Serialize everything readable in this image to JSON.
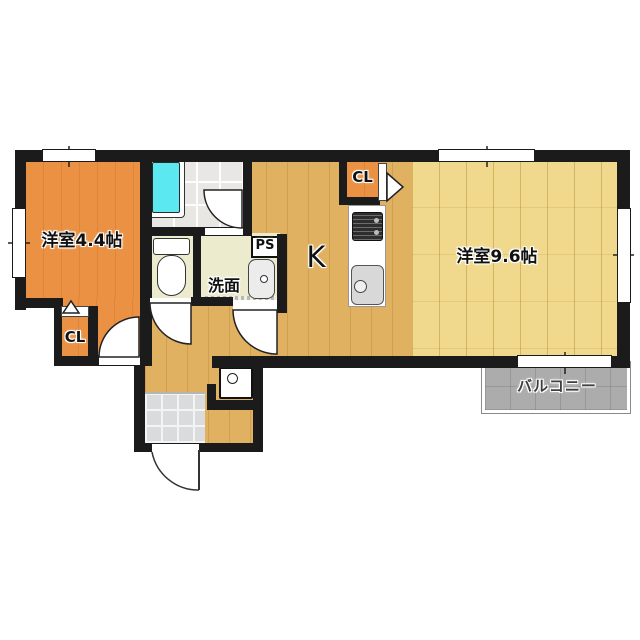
{
  "floorplan": {
    "type": "japanese-apartment-1K-floor-plan",
    "rooms": {
      "western_left": {
        "label": "洋室4.4帖"
      },
      "western_right": {
        "label": "洋室9.6帖"
      },
      "kitchen": {
        "label": "K"
      },
      "washroom": {
        "label": "洗面"
      },
      "balcony": {
        "label": "バルコニー"
      },
      "closet_left": {
        "label": "CL"
      },
      "closet_kitchen": {
        "label": "CL"
      },
      "pipe_shaft": {
        "label": "PS"
      }
    },
    "colors": {
      "wall": "#1b1b1b",
      "room_orange": "#ea9143",
      "wood_tan": "#dfb160",
      "wood_light": "#f0d98d",
      "bath_tile": "#e9e7e3",
      "bathtub": "#5ce8f0",
      "sanitary_floor": "#ecebce",
      "entrance_tile": "#dadbdd",
      "balcony": "#acacac"
    }
  }
}
